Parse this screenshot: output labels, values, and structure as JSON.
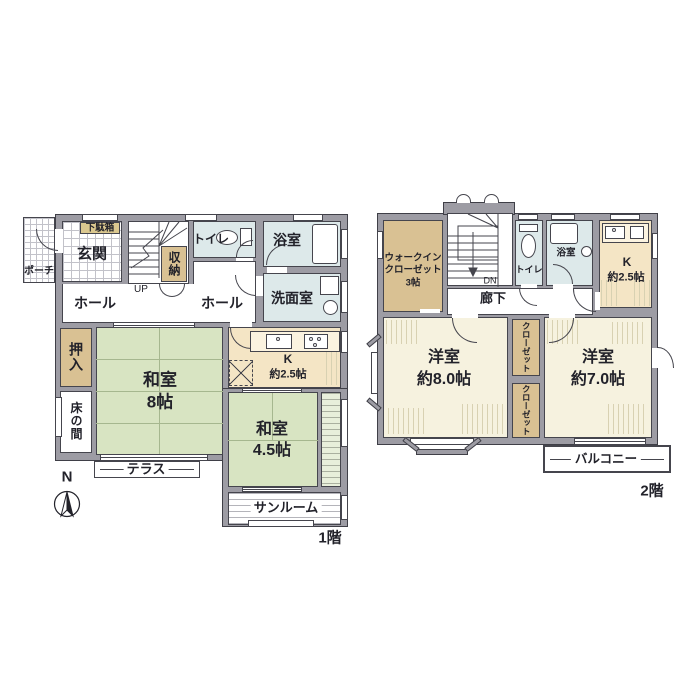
{
  "floor1": {
    "floor_label": "1階",
    "compass": "N",
    "porch": "ポーチ",
    "shoe_cabinet": "下駄箱",
    "entrance": "玄関",
    "storage": "収納",
    "up_label": "UP",
    "toilet": "トイレ",
    "bath": "浴室",
    "hall_left": "ホール",
    "hall_right": "ホール",
    "washroom": "洗面室",
    "oshiire": "押入",
    "tokonoma": "床の間",
    "washitsu8": {
      "name": "和室",
      "size": "8帖"
    },
    "kitchen": {
      "name": "K",
      "size": "約2.5帖"
    },
    "washitsu45": {
      "name": "和室",
      "size": "4.5帖"
    },
    "terrace": "テラス",
    "sunroom": "サンルーム"
  },
  "floor2": {
    "floor_label": "2階",
    "wic": {
      "line1": "ウォークイン",
      "line2": "クローゼット",
      "line3": "3帖"
    },
    "dn_label": "DN",
    "corridor": "廊下",
    "toilet": "トイレ",
    "bath": "浴室",
    "kitchen": {
      "name": "K",
      "size": "約2.5帖"
    },
    "west_room8": {
      "name": "洋室",
      "size": "約8.0帖"
    },
    "closet_upper": "クローゼット",
    "closet_lower": "クローゼット",
    "west_room7": {
      "name": "洋室",
      "size": "約7.0帖"
    },
    "balcony": "バルコニー"
  },
  "colors": {
    "wall": "#9d9ca4",
    "tatami": "#d8e4c2",
    "wet_room": "#dde9ea",
    "closet_tan": "#d9c193",
    "kitchen_cream": "#f4e5c5",
    "west_room_cream": "#f6f2df"
  }
}
